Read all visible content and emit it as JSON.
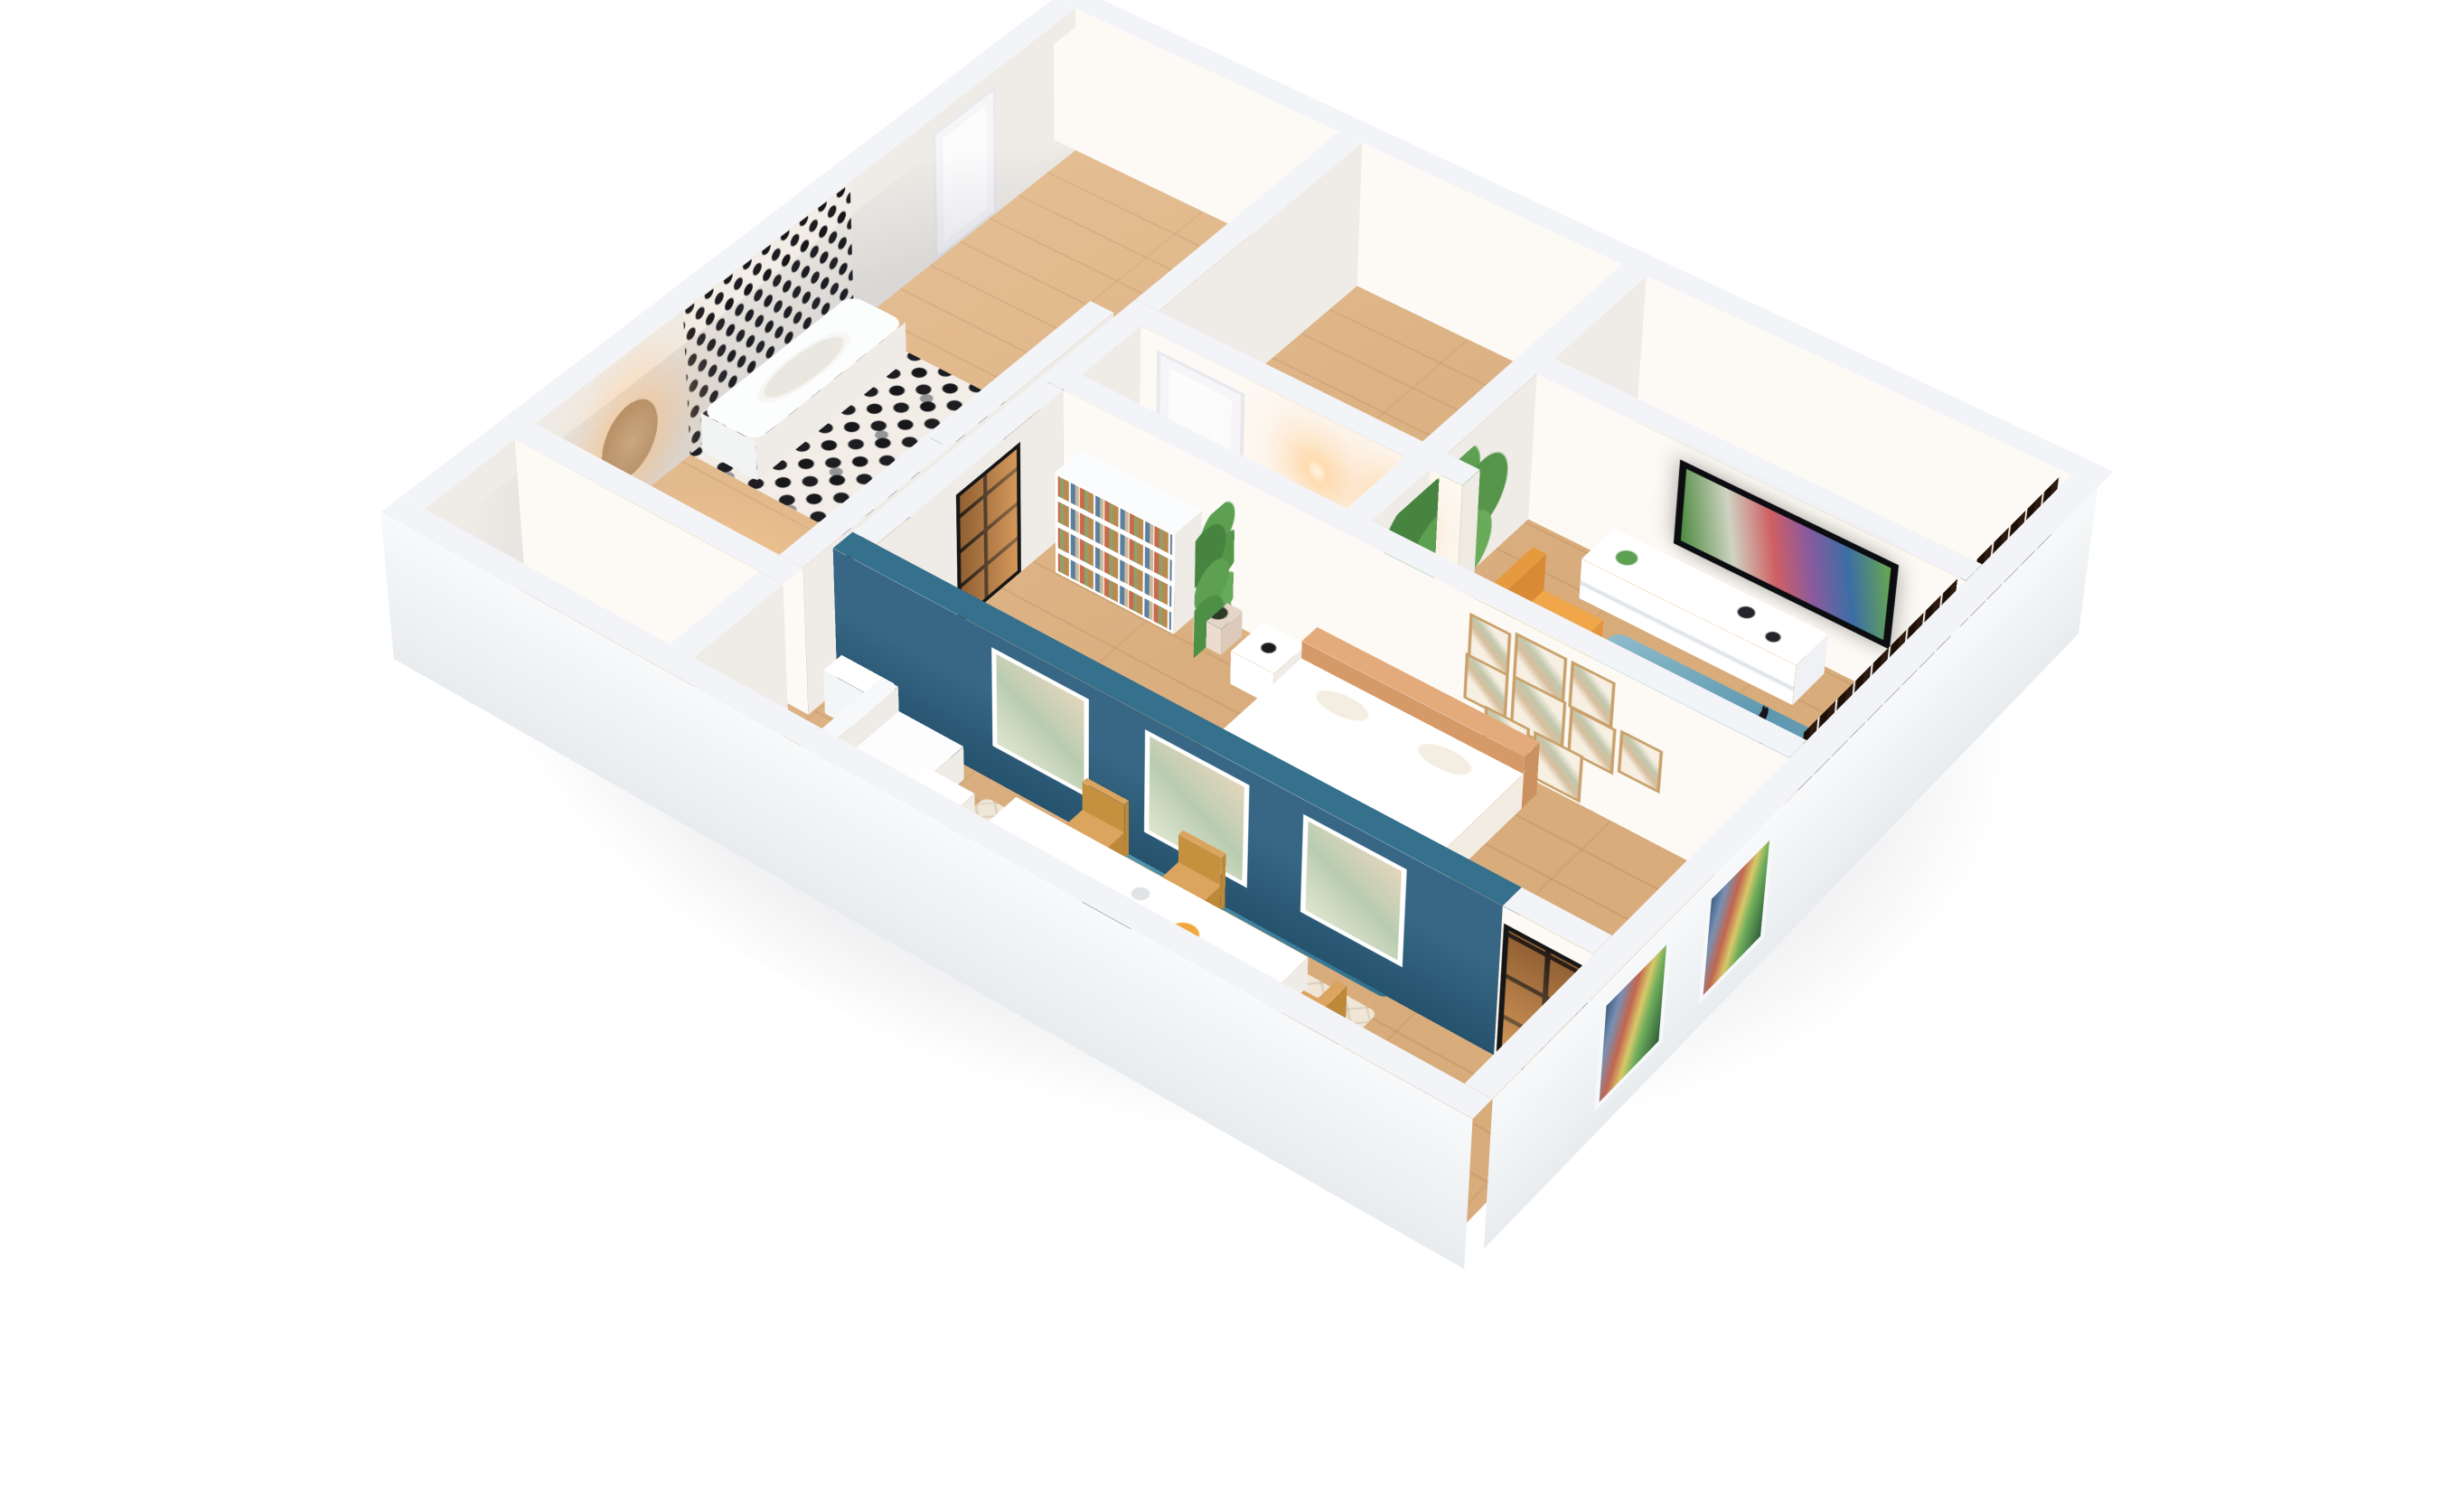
{
  "scene": {
    "type": "architectural-3d-render",
    "subject": "one-bedroom apartment isometric cutaway model",
    "background": "#ffffff",
    "camera": "elevated three-quarter dollhouse view",
    "lighting": "soft daylight with warm interior glow accents"
  },
  "palette": {
    "exterior_wall": "#f2f4f7",
    "interior_wall_lit": "#fdfaf5",
    "interior_wall_shade": "#efece7",
    "wood_floor": "#e0b584",
    "accent_teal_wall": "#2a5d7c",
    "living_rug": "#6fa3ba",
    "bedroom_rug": "#417f9b",
    "armchair": "#f2a64b",
    "linen_white": "#ffffff",
    "headboard_tan": "#e3ab7c",
    "plant_green": "#4e8f46",
    "slat_window_wood": "#2b150a",
    "tile_white": "#f2eee7",
    "tile_black": "#17171b",
    "frame_wood": "#c9a06a",
    "steel_door_black": "#161616",
    "lamp_glow": "#ffd9a0"
  },
  "rooms": [
    {
      "id": "entry-hall",
      "name": "Entry hall",
      "floor": "light oak planks",
      "features": [
        "white entry door",
        "two glowing wall sconces",
        "warm floor light"
      ]
    },
    {
      "id": "bathroom",
      "name": "Bathroom",
      "floor": "black and white hex mosaic tile",
      "features": [
        "bathtub",
        "hex mosaic feature wall",
        "black steel-framed glass door"
      ]
    },
    {
      "id": "vanity-room",
      "name": "Vanity room",
      "floor": "light oak planks",
      "features": [
        "backlit oval wood mirror",
        "black steel-framed glass door",
        "warm glow"
      ]
    },
    {
      "id": "living-room",
      "name": "Living room",
      "floor": "light oak planks",
      "features": [
        "TV playing video on white media console",
        "potted console plant",
        "mustard armchair",
        "teal area rug",
        "tall indoor plants",
        "black floor lamp"
      ]
    },
    {
      "id": "bedroom",
      "name": "Bedroom",
      "floor": "light oak planks",
      "features": [
        "double bed with tan headboard and white duvet",
        "white open nightstand with black lamp",
        "white bookshelf with books",
        "potted plant",
        "gallery wall of nine wood-framed prints",
        "teal rug",
        "black steel-framed glass door"
      ]
    },
    {
      "id": "dining-room",
      "name": "Dining room",
      "floor": "light oak planks",
      "features": [
        "white dining table with carafe, fruit bowl and book",
        "four light-wood chairs",
        "white metal side table",
        "beige flagstone rug",
        "teal accent wall with three white-framed botanical prints",
        "white L-shaped sofa",
        "white kitchen cabinets",
        "black steel-framed glass door"
      ]
    }
  ],
  "exterior": {
    "features": [
      "white cut-away walls",
      "dark wood slat window wall on the right",
      "two picture windows with garden view on the front-right wall",
      "soft ground shadow under the model"
    ]
  }
}
